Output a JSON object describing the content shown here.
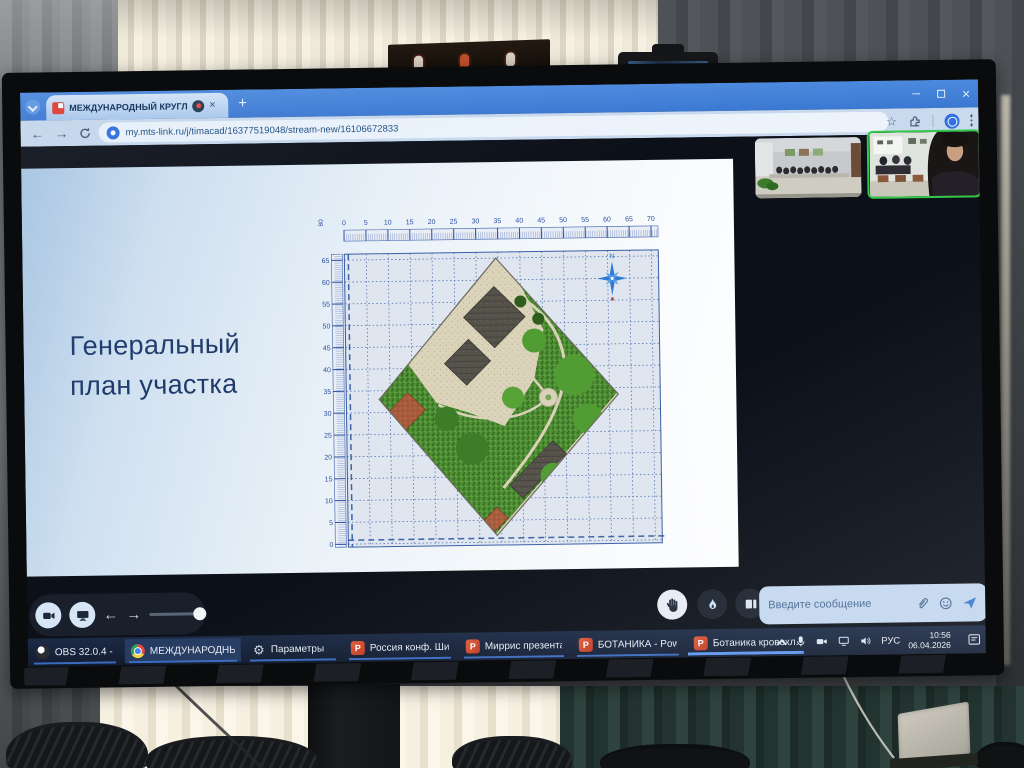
{
  "browser": {
    "tab_title": "МЕЖДУНАРОДНЫЙ КРУГЛ",
    "url": "my.mts-link.ru/j/timacad/16377519048/stream-new/16106672833"
  },
  "icons": {
    "back": "←",
    "forward": "→",
    "star": "☆",
    "minimize": "─",
    "close": "×",
    "new_tab": "+",
    "tab_close": "×"
  },
  "meeting": {
    "slide": {
      "title_lines": [
        "Генеральный",
        "план участка"
      ]
    },
    "chat": {
      "placeholder": "Введите сообщение"
    }
  },
  "plan": {
    "type": "site-plan",
    "x_ticks": [
      0,
      5,
      10,
      15,
      20,
      25,
      30,
      35,
      40,
      45,
      50,
      55,
      60,
      65,
      70
    ],
    "y_ticks": [
      0,
      5,
      10,
      15,
      20,
      25,
      30,
      35,
      40,
      45,
      50,
      55,
      60,
      65
    ],
    "corner_label": "80",
    "compass_label": "N"
  },
  "taskbar": {
    "items": [
      {
        "label": "OBS 32.0.4 - Проф...",
        "icon": "obs"
      },
      {
        "label": "МЕЖДУНАРОДНЫ...",
        "icon": "chrome",
        "state": "active"
      },
      {
        "label": "Параметры",
        "icon": "gear"
      },
      {
        "label": "Россия конф. Ши...",
        "icon": "ppt"
      },
      {
        "label": "Миррис презента...",
        "icon": "ppt"
      },
      {
        "label": "БОТАНИКА - Powe...",
        "icon": "ppt"
      },
      {
        "label": "Ботаника кровохл...",
        "icon": "ppt",
        "state": "active-wide"
      }
    ],
    "tray": {
      "language": "РУС",
      "time": "10:56",
      "date": "06.04.2026"
    }
  }
}
